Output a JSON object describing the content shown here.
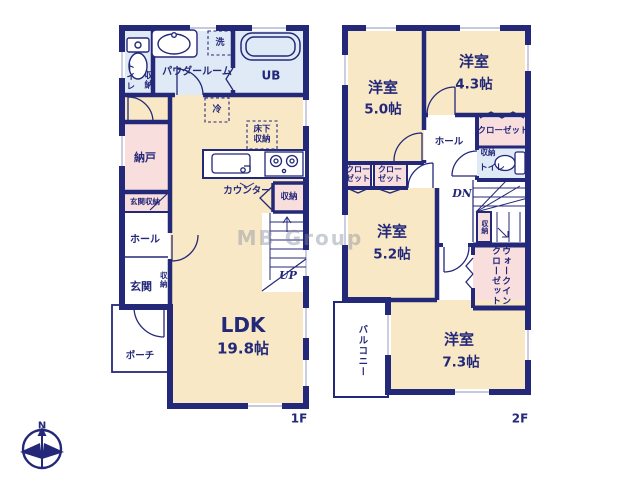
{
  "watermark": "MB Group",
  "compass": {
    "north": "N"
  },
  "colors": {
    "wall": "#242879",
    "room_beige": "#f8e8c6",
    "closet_pink": "#f9dede",
    "bath_blue": "#dfeaf6"
  },
  "floor1": {
    "label": "1F",
    "rooms": {
      "toilet": "トイレ",
      "toilet_storage": "収納",
      "powder_room": "パウダールーム",
      "laundry": "洗",
      "unit_bath": "UB",
      "fridge": "冷",
      "floor_storage": [
        "床下",
        "収納"
      ],
      "nando": "納戸",
      "entrance_storage": "玄関収納",
      "hall": "ホール",
      "entrance": "玄関",
      "entrance_side_storage": "収納",
      "porch": "ポーチ",
      "counter": "カウンター",
      "kitchen_storage": "収納",
      "stairs_up": "UP",
      "ldk": {
        "name": "LDK",
        "size": "19.8帖"
      }
    }
  },
  "floor2": {
    "label": "2F",
    "rooms": {
      "bedroom_a": {
        "name": "洋室",
        "size": "5.0帖"
      },
      "bedroom_b": {
        "name": "洋室",
        "size": "4.3帖"
      },
      "closet_top": "クローゼット",
      "toilet_storage": "収納",
      "toilet": "トイレ",
      "hall": "ホール",
      "closet_1": [
        "クロー",
        "ゼット"
      ],
      "closet_2": [
        "クロー",
        "ゼット"
      ],
      "bedroom_c": {
        "name": "洋室",
        "size": "5.2帖"
      },
      "stairs_down": "DN",
      "stair_storage": "収納",
      "walk_in_closet": [
        "ウォークイン",
        "クローゼット"
      ],
      "balcony": "バルコニー",
      "bedroom_d": {
        "name": "洋室",
        "size": "7.3帖"
      }
    }
  }
}
